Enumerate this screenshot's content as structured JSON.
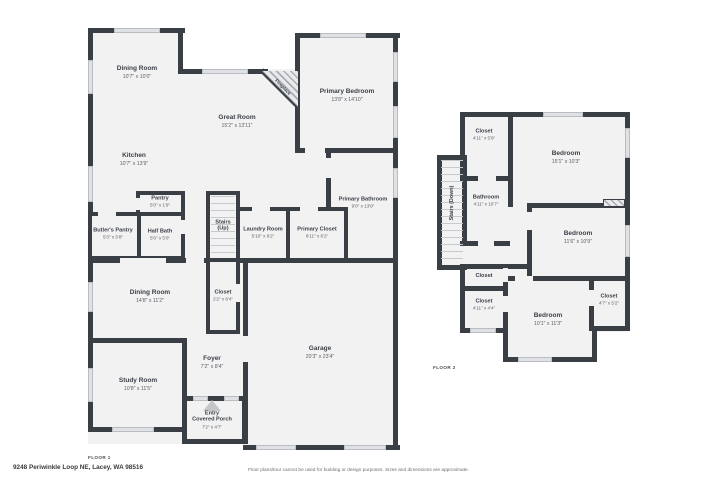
{
  "page": {
    "floor1_label": "FLOOR 1",
    "floor2_label": "FLOOR 2",
    "address": "9248 Periwinkle Loop NE, Lacey, WA 98516",
    "disclaimer": "Floor plans/tour cannot be used for building or design purposes. Sizes and dimensions are approximate."
  },
  "floor1": {
    "dining_room_top": {
      "name": "Dining Room",
      "dims": "10'7\" x 10'0\""
    },
    "great_room": {
      "name": "Great Room",
      "dims": "15'2\" x 13'11\""
    },
    "fireplace": {
      "name": "Fireplace"
    },
    "primary_bedroom": {
      "name": "Primary Bedroom",
      "dims": "13'8\" x 14'10\""
    },
    "kitchen": {
      "name": "Kitchen",
      "dims": "10'7\" x 13'9\""
    },
    "pantry": {
      "name": "Pantry",
      "dims": "5'0\" x 1'9\""
    },
    "butlers_pantry": {
      "name": "Butler's Pantry",
      "dims": "5'3\" x 5'8\""
    },
    "half_bath": {
      "name": "Half Bath",
      "dims": "5'6\" x 5'0\""
    },
    "stairs_up": {
      "name1": "Stairs",
      "name2": "(Up)"
    },
    "laundry_room": {
      "name": "Laundry Room",
      "dims": "5'10\" x 6'2\""
    },
    "primary_closet": {
      "name": "Primary Closet",
      "dims": "6'11\" x 6'2\""
    },
    "primary_bathroom": {
      "name": "Primary Bathroom",
      "dims": "9'0\" x 13'9\""
    },
    "dining_room_lower": {
      "name": "Dining Room",
      "dims": "14'8\" x 11'2\""
    },
    "closet": {
      "name": "Closet",
      "dims": "2'2\" x 8'4\""
    },
    "study_room": {
      "name": "Study Room",
      "dims": "10'8\" x 11'5\""
    },
    "foyer": {
      "name": "Foyer",
      "dims": "7'2\" x 8'4\""
    },
    "entry_porch": {
      "name1": "Entry",
      "name2": "Covered Porch",
      "dims": "7'2\" x 4'7\""
    },
    "garage": {
      "name": "Garage",
      "dims": "20'3\" x 23'4\""
    }
  },
  "floor2": {
    "closet_top": {
      "name": "Closet",
      "dims": "4'11\" x 5'9\""
    },
    "bedroom_1": {
      "name": "Bedroom",
      "dims": "15'1\" x 10'3\""
    },
    "bathroom": {
      "name": "Bathroom",
      "dims": "4'11\" x 10'7\""
    },
    "stairs_down": {
      "name": "Stairs (Down)"
    },
    "bedroom_2": {
      "name": "Bedroom",
      "dims": "11'6\" x 10'9\""
    },
    "closet_mid": {
      "name": "Closet"
    },
    "closet_left": {
      "name": "Closet",
      "dims": "4'11\" x 4'4\""
    },
    "bedroom_3": {
      "name": "Bedroom",
      "dims": "10'1\" x 11'3\""
    },
    "closet_right": {
      "name": "Closet",
      "dims": "4'7\" x 5'2\""
    }
  },
  "colors": {
    "wall": "#3a3f46",
    "floor_fill": "#f2f2f3",
    "window": "#dfe1e4",
    "background": "#ffffff"
  }
}
